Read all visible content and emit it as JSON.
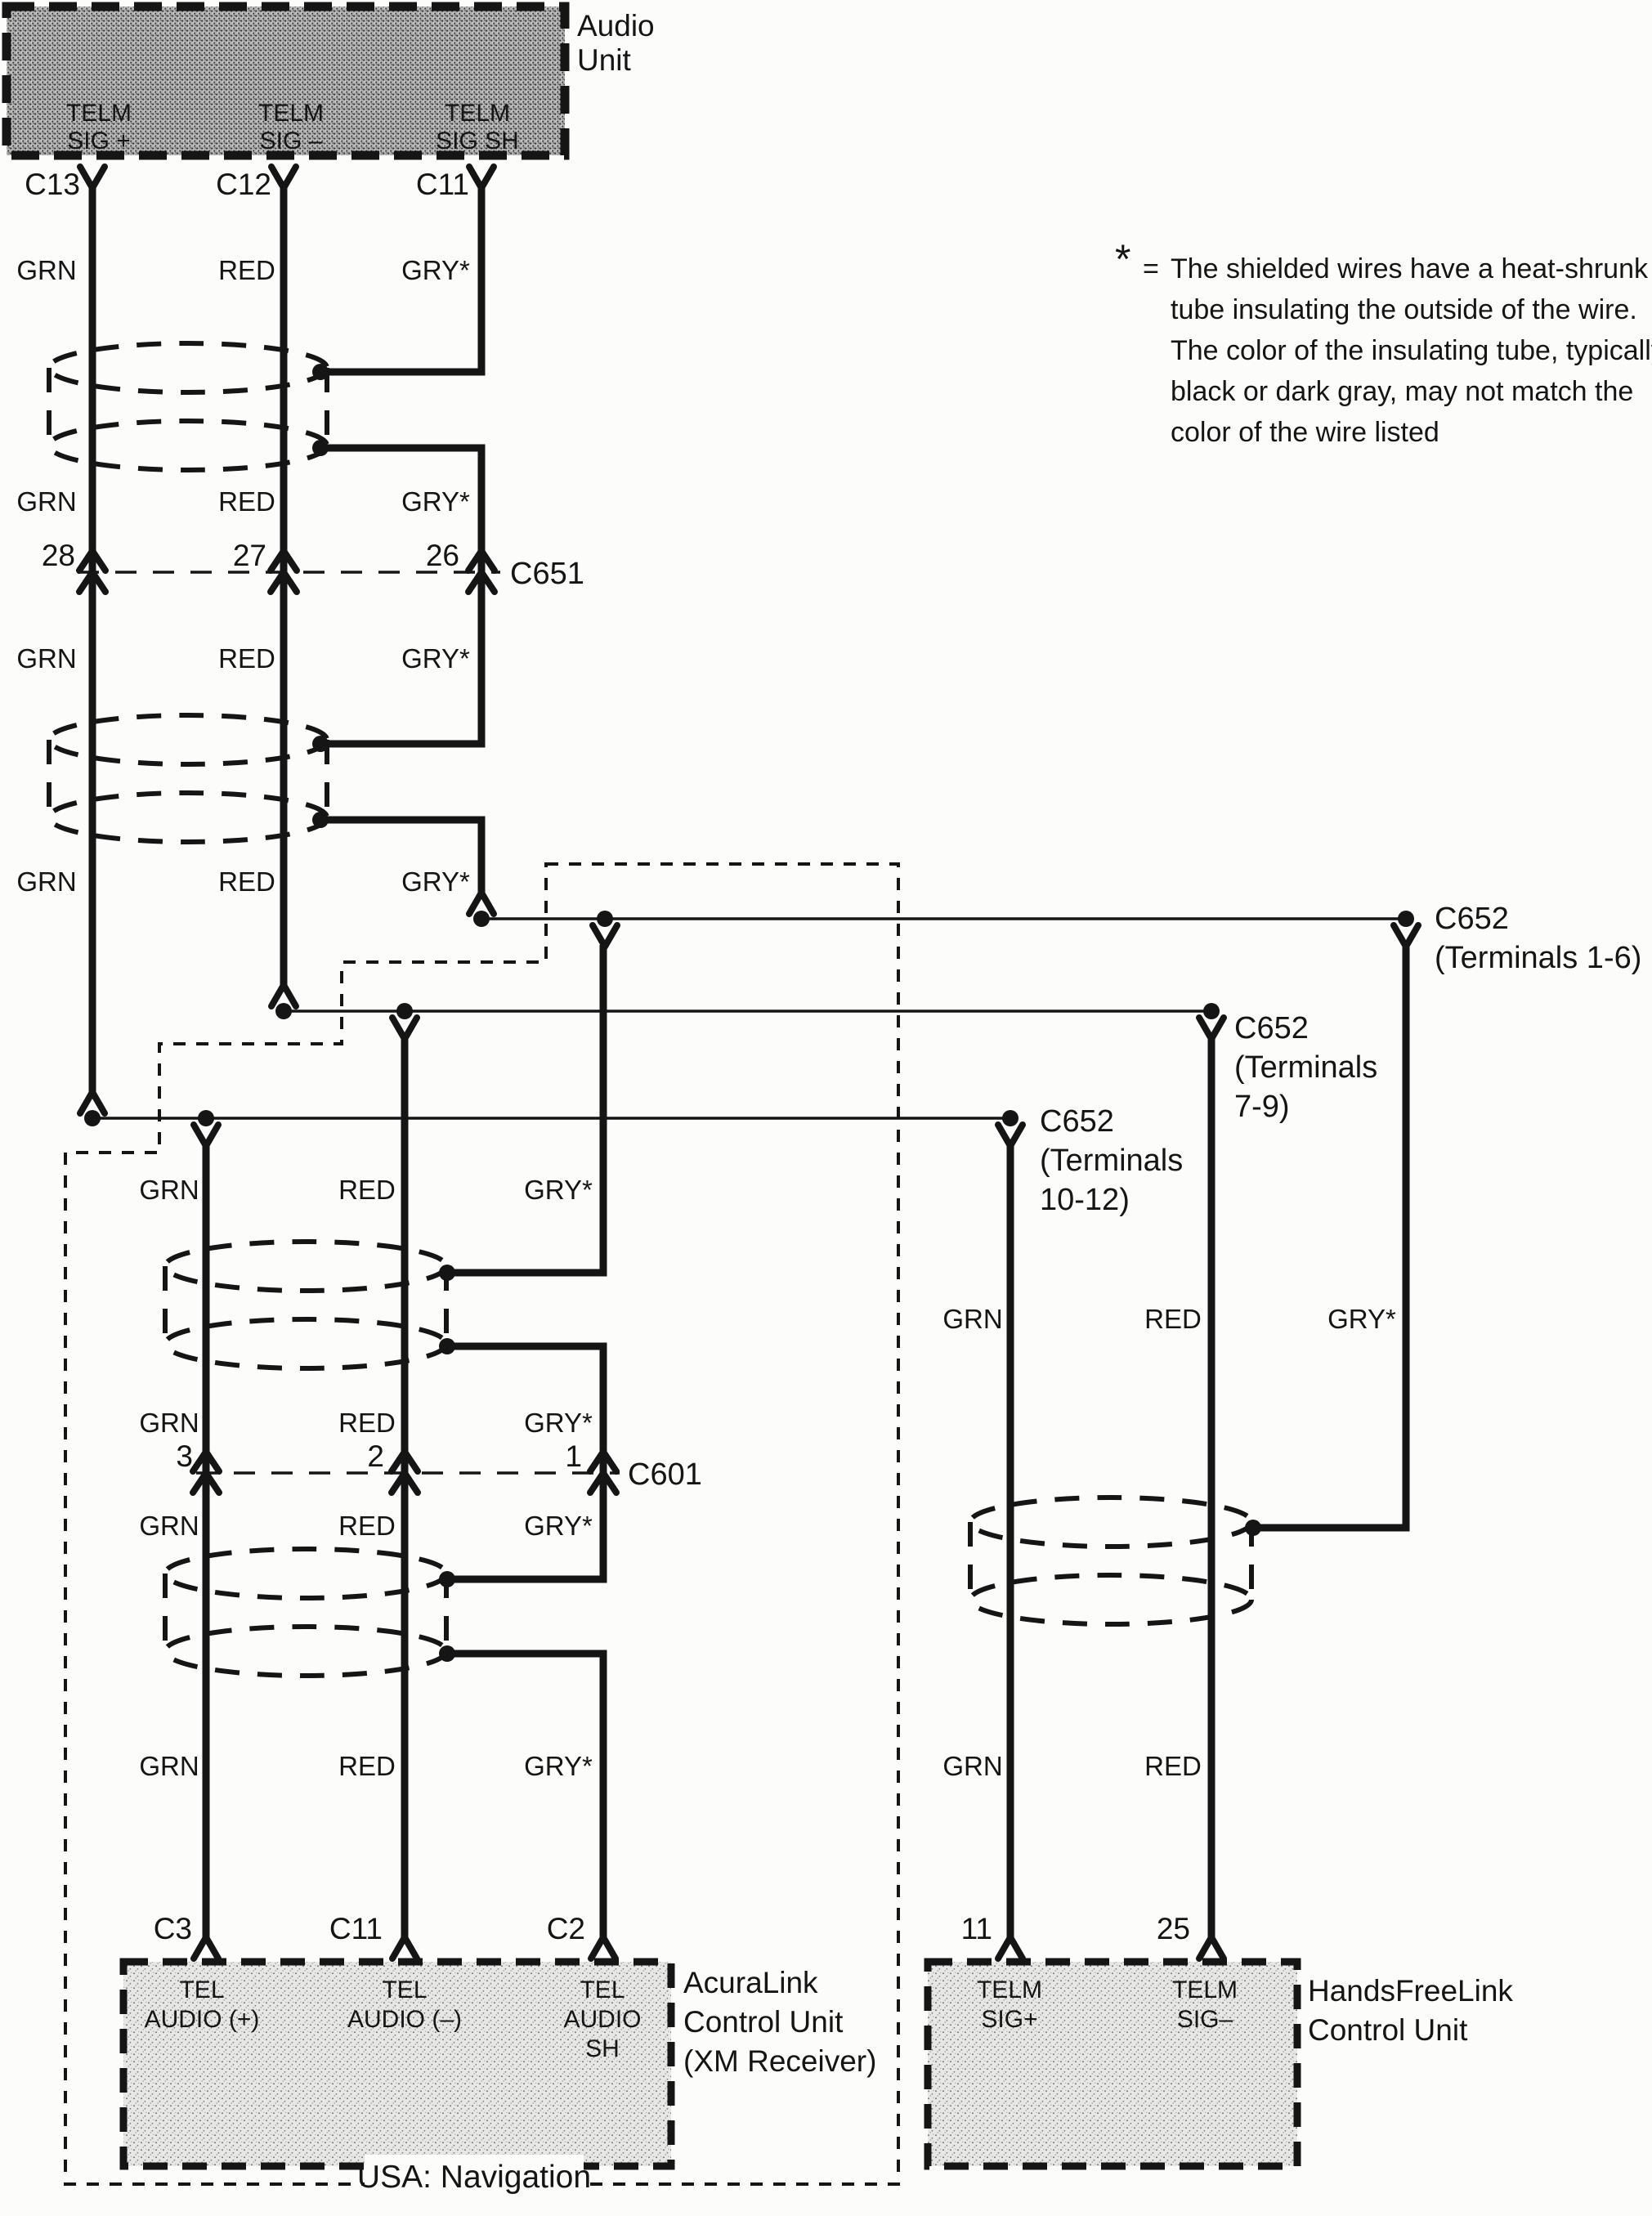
{
  "note": {
    "symbol": "*",
    "equals": "=",
    "lines": [
      "The shielded wires have a heat-shrunk",
      "tube insulating the outside of the wire.",
      "The color of the insulating tube, typically",
      "black or dark gray, may not match the",
      "color of the wire listed"
    ]
  },
  "wire_labels": {
    "grn": "GRN",
    "red": "RED",
    "gry": "GRY*"
  },
  "audio_unit": {
    "title": [
      "Audio",
      "Unit"
    ],
    "pins": [
      "C13",
      "C12",
      "C11"
    ],
    "terminals": [
      [
        "TELM",
        "SIG +"
      ],
      [
        "TELM",
        "SIG –"
      ],
      [
        "TELM",
        "SIG SH"
      ]
    ]
  },
  "connectors": {
    "c651": {
      "label": "C651",
      "pins": [
        "28",
        "27",
        "26"
      ]
    },
    "c601": {
      "label": "C601",
      "pins": [
        "3",
        "2",
        "1"
      ]
    },
    "c652_1_6": {
      "lines": [
        "C652",
        "(Terminals 1-6)"
      ]
    },
    "c652_7_9": {
      "lines": [
        "C652",
        "(Terminals",
        "7-9)"
      ]
    },
    "c652_10_12": {
      "lines": [
        "C652",
        "(Terminals",
        "10-12)"
      ]
    }
  },
  "acuralink": {
    "title": [
      "AcuraLink",
      "Control Unit",
      "(XM Receiver)"
    ],
    "pins": [
      "C3",
      "C11",
      "C2"
    ],
    "terminals": [
      [
        "TEL",
        "AUDIO (+)"
      ],
      [
        "TEL",
        "AUDIO (–)"
      ],
      [
        "TEL",
        "AUDIO",
        "SH"
      ]
    ]
  },
  "handsfreelink": {
    "title": [
      "HandsFreeLink",
      "Control Unit"
    ],
    "pins": [
      "11",
      "25"
    ],
    "terminals": [
      [
        "TELM",
        "SIG+"
      ],
      [
        "TELM",
        "SIG–"
      ]
    ]
  },
  "region": {
    "label": "USA: Navigation"
  }
}
